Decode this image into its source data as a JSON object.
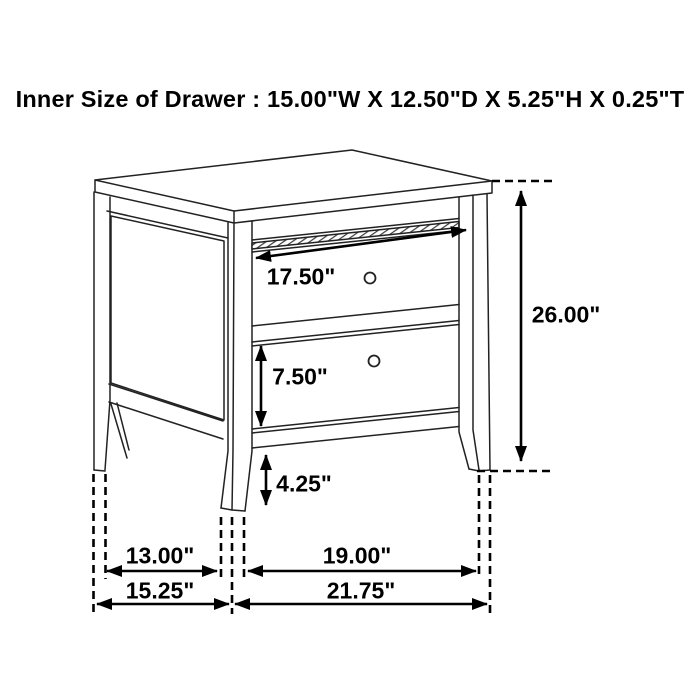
{
  "title": "Inner Size of Drawer : 15.00\"W X 12.50\"D X 5.25\"H X 0.25\"T",
  "figure": {
    "subject": "two-drawer-nightstand-line-drawing"
  },
  "dimensions": {
    "top_drawer_width": "17.50\"",
    "overall_height": "26.00\"",
    "bottom_drawer_front_height": "7.50\"",
    "leg_clearance_height": "4.25\"",
    "side_leg_spacing": "13.00\"",
    "front_leg_spacing": "19.00\"",
    "overall_depth": "15.25\"",
    "overall_width": "21.75\""
  },
  "colors": {
    "background": "#ffffff",
    "drawing_line": "#222222",
    "dimension_line": "#000000",
    "text": "#000000"
  }
}
